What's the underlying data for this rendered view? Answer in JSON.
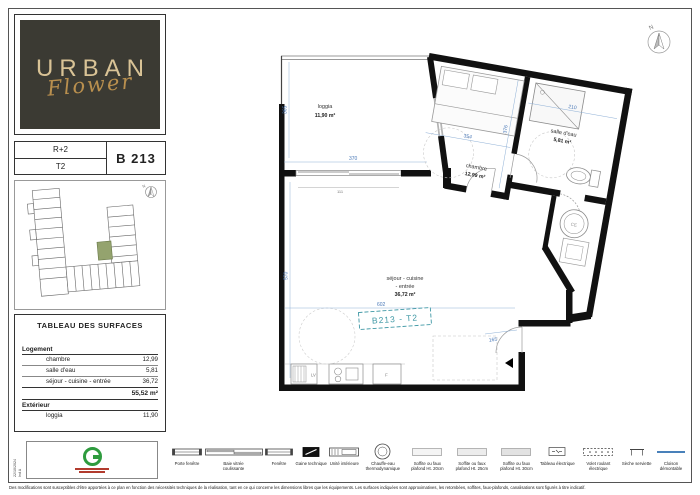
{
  "brand": {
    "line1": "URBAN",
    "line2": "Flower"
  },
  "unit": {
    "floor": "R+2",
    "type": "T2",
    "number": "B 213"
  },
  "site_plan": {
    "compass": "N"
  },
  "surfaces": {
    "title": "TABLEAU DES SURFACES",
    "sections": [
      {
        "label": "Logement",
        "rows": [
          {
            "name": "chambre",
            "value": "12,99"
          },
          {
            "name": "salle d'eau",
            "value": "5,81"
          },
          {
            "name": "séjour - cuisine - entrée",
            "value": "36,72"
          }
        ]
      },
      {
        "label": "Extérieur",
        "rows": [
          {
            "name": "loggia",
            "value": "11,90"
          }
        ]
      }
    ],
    "total": "55,52 m²"
  },
  "plan": {
    "tag": "B213 - T2",
    "compass": "N",
    "rooms": {
      "loggia": {
        "name": "loggia",
        "area": "11,90 m²"
      },
      "chambre": {
        "name": "chambre",
        "area": "12,99 m²"
      },
      "salle_eau": {
        "name": "salle d'eau",
        "area": "5,81 m²"
      },
      "sejour": {
        "line1": "séjour - cuisine",
        "line2": "- entrée",
        "area": "36,72 m²"
      }
    },
    "dims": {
      "loggia_w": "370",
      "loggia_h": "365",
      "window": "111",
      "chambre_w": "354",
      "chambre_h": "376",
      "salle_eau_w": "210",
      "sejour_h": "570",
      "sejour_w": "602",
      "entree": "165"
    },
    "appliances": {
      "lv": "LV",
      "fridge": "F",
      "water_heater": "CE"
    }
  },
  "stamp": {
    "date": "22/10/2024",
    "index": "Ind A"
  },
  "legend": {
    "items": [
      {
        "label": "Porte fenêtre"
      },
      {
        "label": "Baie vitrée coulissante"
      },
      {
        "label": "Fenêtre"
      },
      {
        "label": "Gaine technique"
      },
      {
        "label": "Unité intérieure"
      },
      {
        "label": "Chauffe-eau thermodynamique"
      },
      {
        "label": "Soffite ou faux plafond Ht. 20cm"
      },
      {
        "label": "Soffite ou faux plafond Ht. 25cm"
      },
      {
        "label": "Soffite ou faux plafond Ht. 30cm"
      },
      {
        "label": "Tableau électrique"
      },
      {
        "label": "Volet roulant électrique"
      },
      {
        "label": "Sèche serviette"
      },
      {
        "label": "Cloison démontable"
      }
    ]
  },
  "disclaimer": "Des modifications sont susceptibles d'être apportées à ce plan en fonction des nécessités techniques de la réalisation, tant en ce qui concerne les dimensions libres que les équipements. Les surfaces indiquées sont approximatives, les retombées, soffites, faux-plafonds, canalisations sont figurés à titre indicatif.",
  "colors": {
    "wall": "#111111",
    "dimension_blue": "#4a79b8",
    "tag_teal": "#3f98a5",
    "logo_gold": "#c2a164",
    "logo_bg": "#3b3a33",
    "stamp_green": "#2e9b3e",
    "stamp_red": "#b23b2e",
    "unit_highlight": "#94a36e"
  }
}
